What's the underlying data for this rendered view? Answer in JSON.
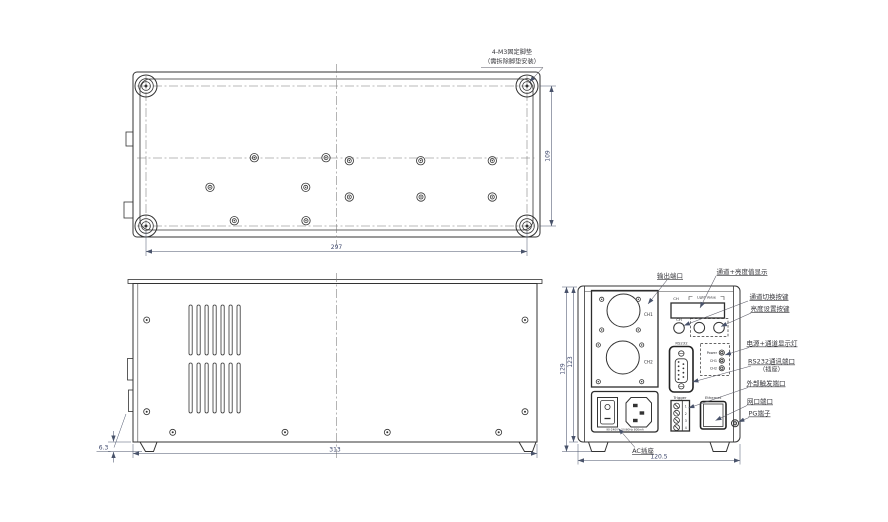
{
  "note": {
    "line1": "4-M3固定脚垫",
    "line2": "（需拆除脚垫安装）"
  },
  "bottom_view": {
    "width_dim": "297",
    "height_dim": "109"
  },
  "side_view": {
    "width_dim": "313",
    "foot_dim": "6.3"
  },
  "rear_view": {
    "height_outer_dim": "129",
    "height_inner_dim": "123",
    "width_dim": "120.5",
    "display_ch": "CH",
    "display_value": "Light Value",
    "btn_ch": "CH",
    "conn_ch1": "CH1",
    "conn_ch2": "CH2",
    "rs232_label": "RS232",
    "led_labels": {
      "power": "Power",
      "ch1": "CH1",
      "ch2": "CH2"
    },
    "trigger_label": "Trigger",
    "trigger_pins": [
      "1",
      "2",
      "3",
      "4"
    ],
    "ethernet_label": "Ethernet",
    "ac_rating": "90-240V~ 50/60Hz 800mA"
  },
  "callouts": {
    "output_port": "输出端口",
    "display": "通道+亮度值显示",
    "channel_switch": "通道切换按键",
    "brightness_set": "亮度设置按键",
    "power_leds": "电源+通道显示灯",
    "rs232_line1": "RS232通讯端口",
    "rs232_line2": "（插座）",
    "trigger_port": "外部触发端口",
    "lan_port": "网口端口",
    "pg_terminal": "PG端子",
    "ac_socket": "AC插座"
  },
  "colors": {
    "line": "#333333",
    "dim": "#49536b",
    "background": "#ffffff"
  }
}
